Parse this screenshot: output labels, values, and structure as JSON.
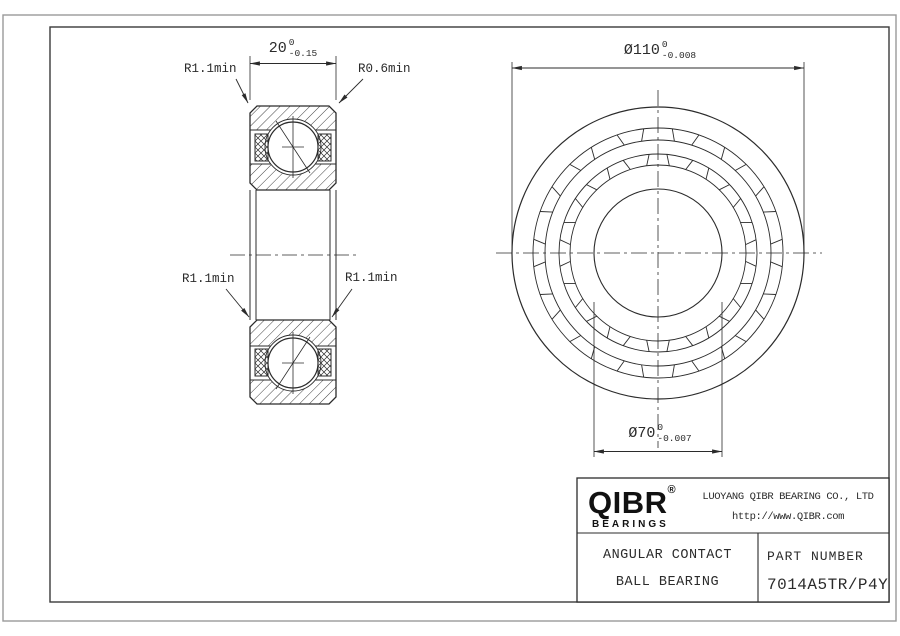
{
  "section_view": {
    "width_dim": {
      "value": "20",
      "tol_upper": "0",
      "tol_lower": "-0.15"
    },
    "labels": {
      "top_left": "R1.1min",
      "top_right": "R0.6min",
      "mid_left": "R1.1min",
      "mid_right": "R1.1min"
    }
  },
  "front_view": {
    "od_dim": {
      "value": "Ø110",
      "tol_upper": "0",
      "tol_lower": "-0.008"
    },
    "bore_dim": {
      "value": "Ø70",
      "tol_upper": "0",
      "tol_lower": "-0.007"
    }
  },
  "title_block": {
    "logo": {
      "text": "QIBR",
      "registered": "®",
      "sub": "BEARINGS"
    },
    "company": "LUOYANG QIBR BEARING CO., LTD",
    "website": "http://www.QIBR.com",
    "product_line1": "ANGULAR CONTACT",
    "product_line2": "BALL BEARING",
    "part_number_label": "PART NUMBER",
    "part_number": "7014A5TR/P4Y"
  },
  "colors": {
    "line": "#2b2b2b",
    "outer_frame": "#9a9a9a",
    "inner_frame": "#3a3a3a",
    "logo": "#111111",
    "background": "#ffffff"
  }
}
